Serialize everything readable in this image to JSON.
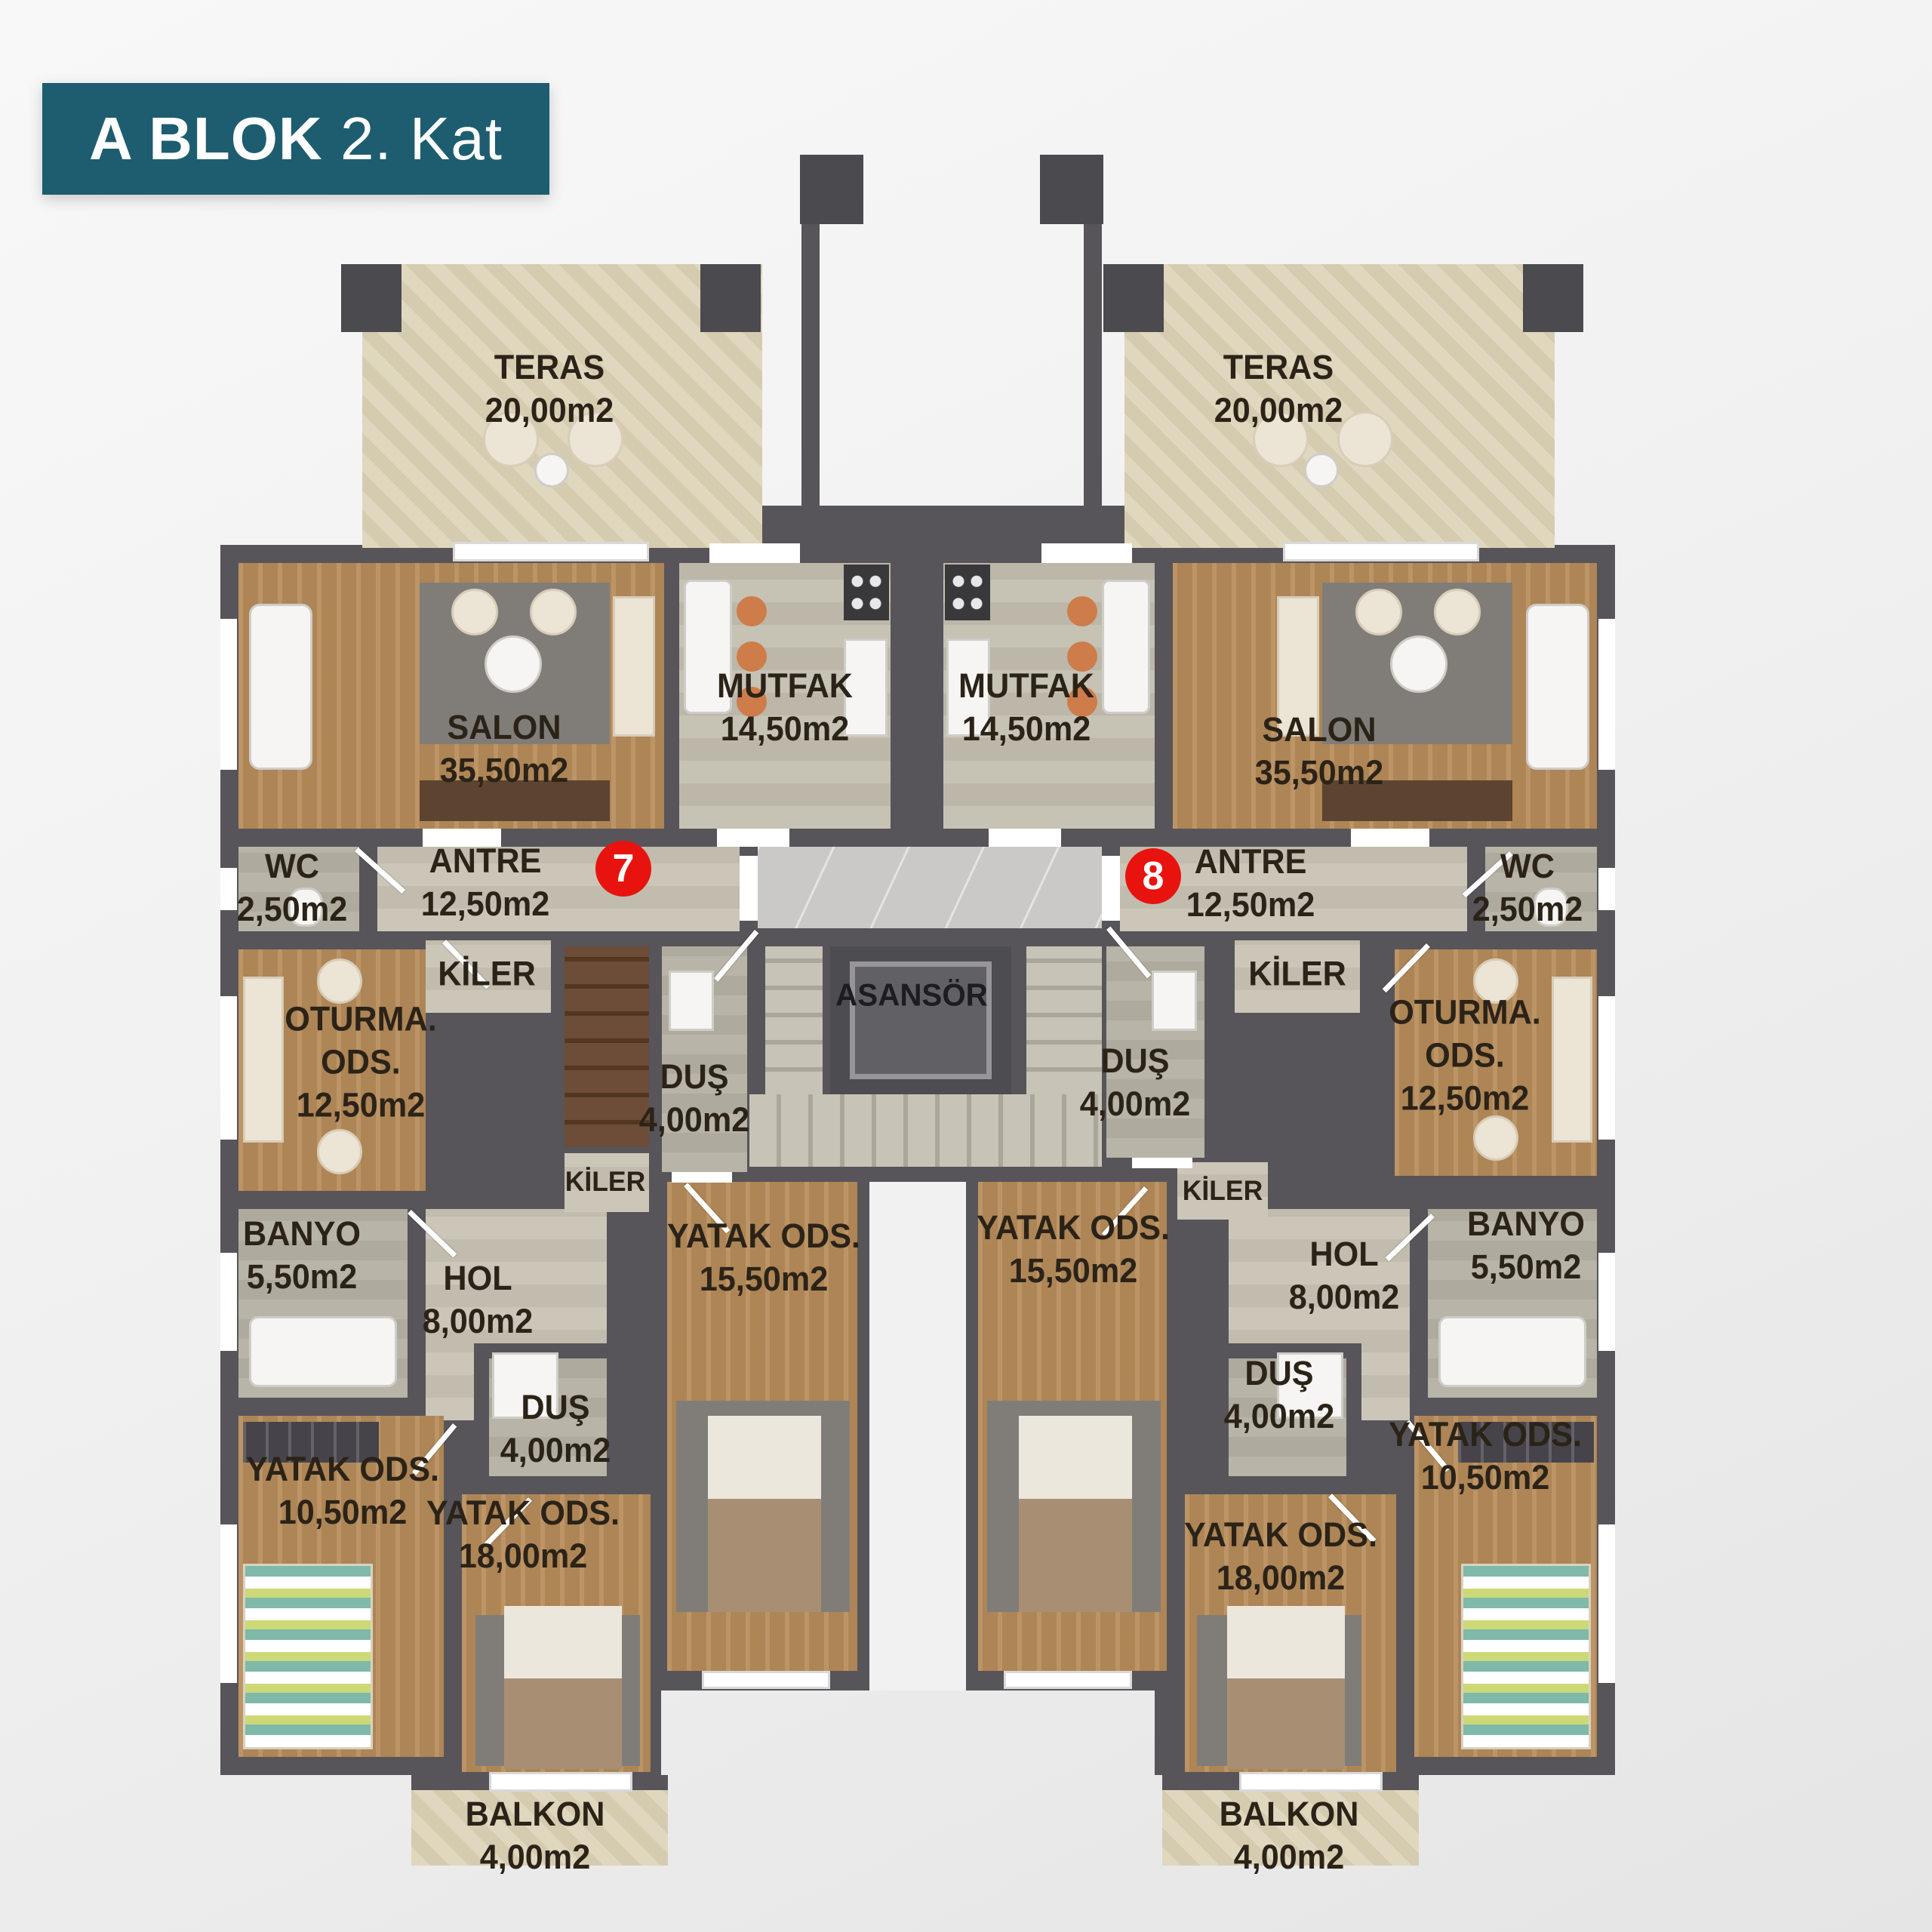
{
  "title": {
    "block_name": "A BLOK",
    "floor_name": "2. Kat"
  },
  "units": {
    "left": {
      "number": "7"
    },
    "right": {
      "number": "8"
    }
  },
  "core": {
    "elevator": {
      "name": "ASANSÖR"
    }
  },
  "rooms": {
    "teras_left": {
      "name": "TERAS",
      "area": "20,00m2"
    },
    "teras_right": {
      "name": "TERAS",
      "area": "20,00m2"
    },
    "salon_left": {
      "name": "SALON",
      "area": "35,50m2"
    },
    "salon_right": {
      "name": "SALON",
      "area": "35,50m2"
    },
    "mutfak_left": {
      "name": "MUTFAK",
      "area": "14,50m2"
    },
    "mutfak_right": {
      "name": "MUTFAK",
      "area": "14,50m2"
    },
    "wc_left": {
      "name": "WC",
      "area": "2,50m2"
    },
    "wc_right": {
      "name": "WC",
      "area": "2,50m2"
    },
    "antre_left": {
      "name": "ANTRE",
      "area": "12,50m2"
    },
    "antre_right": {
      "name": "ANTRE",
      "area": "12,50m2"
    },
    "kiler_left_upper": {
      "name": "KİLER"
    },
    "kiler_right_upper": {
      "name": "KİLER"
    },
    "kiler_left_lower": {
      "name": "KİLER"
    },
    "kiler_right_lower": {
      "name": "KİLER"
    },
    "oturma_left": {
      "name": "OTURMA.",
      "name2": "ODS.",
      "area": "12,50m2"
    },
    "oturma_right": {
      "name": "OTURMA.",
      "name2": "ODS.",
      "area": "12,50m2"
    },
    "dus_left_mid": {
      "name": "DUŞ",
      "area": "4,00m2"
    },
    "dus_right_mid": {
      "name": "DUŞ",
      "area": "4,00m2"
    },
    "dus_left_lower": {
      "name": "DUŞ",
      "area": "4,00m2"
    },
    "dus_right_lower": {
      "name": "DUŞ",
      "area": "4,00m2"
    },
    "banyo_left": {
      "name": "BANYO",
      "area": "5,50m2"
    },
    "banyo_right": {
      "name": "BANYO",
      "area": "5,50m2"
    },
    "hol_left": {
      "name": "HOL",
      "area": "8,00m2"
    },
    "hol_right": {
      "name": "HOL",
      "area": "8,00m2"
    },
    "yatak_left_15": {
      "name": "YATAK ODS.",
      "area": "15,50m2"
    },
    "yatak_right_15": {
      "name": "YATAK ODS.",
      "area": "15,50m2"
    },
    "yatak_left_10": {
      "name": "YATAK ODS.",
      "area": "10,50m2"
    },
    "yatak_right_10": {
      "name": "YATAK ODS.",
      "area": "10,50m2"
    },
    "yatak_left_18": {
      "name": "YATAK ODS.",
      "area": "18,00m2"
    },
    "yatak_right_18": {
      "name": "YATAK ODS.",
      "area": "18,00m2"
    },
    "balkon_left": {
      "name": "BALKON",
      "area": "4,00m2"
    },
    "balkon_right": {
      "name": "BALKON",
      "area": "4,00m2"
    }
  },
  "colors": {
    "banner_teal": "#1e5d6f",
    "marker_red": "#e8130e",
    "wall_gray": "#57555a",
    "wood_floor": "#b78c5a",
    "terrace_tile": "#dcd2b6",
    "kitchen_tile": "#c2bdae",
    "bath_tile": "#b4afa2",
    "marble_landing": "#cac9c7",
    "stair_brown": "#6d4c38",
    "label_text": "#2b2318",
    "background": "#f1f1f1"
  }
}
